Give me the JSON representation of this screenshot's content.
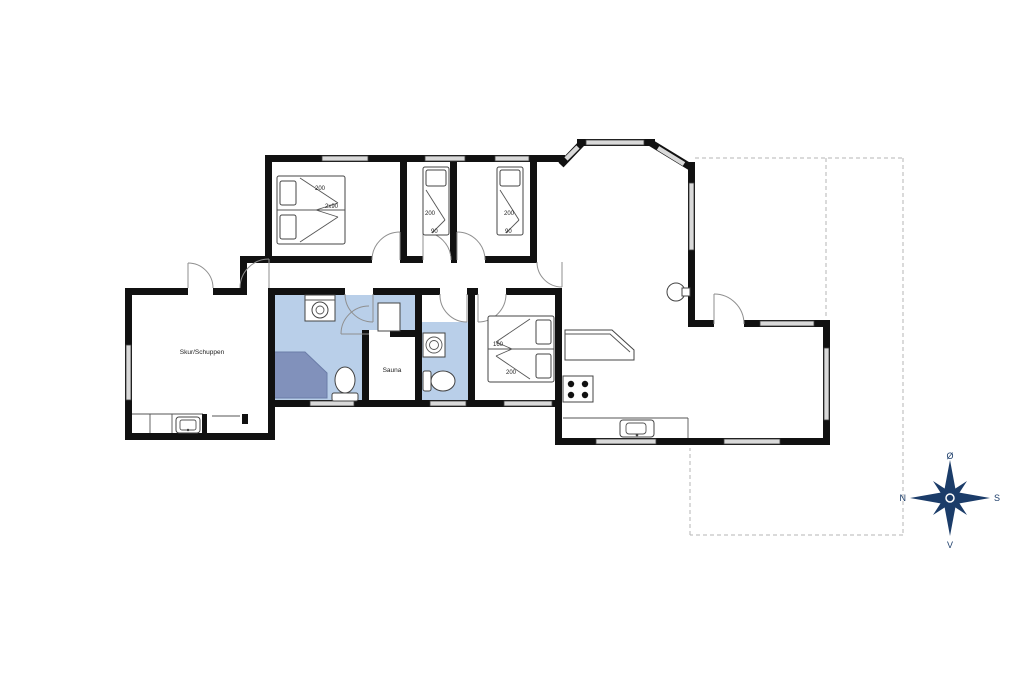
{
  "plan": {
    "rooms": {
      "shed_label": "Skur/Schuppen",
      "sauna_label": "Sauna"
    },
    "beds": {
      "bedroom1": {
        "length": "200",
        "size": "2x90"
      },
      "bedroom2": {
        "length": "200",
        "width": "90"
      },
      "bedroom3": {
        "length": "200",
        "width": "90"
      },
      "bedroom4": {
        "width": "160",
        "length": "200"
      }
    },
    "compass": {
      "east": "Ø",
      "north": "N",
      "south": "S",
      "west": "V"
    },
    "colors": {
      "wall": "#111111",
      "window_fill": "#d9d9d9",
      "bathroom_blue": "#b9cfe9",
      "shower_blue": "#8191bb",
      "compass_navy": "#1b3c69"
    }
  }
}
